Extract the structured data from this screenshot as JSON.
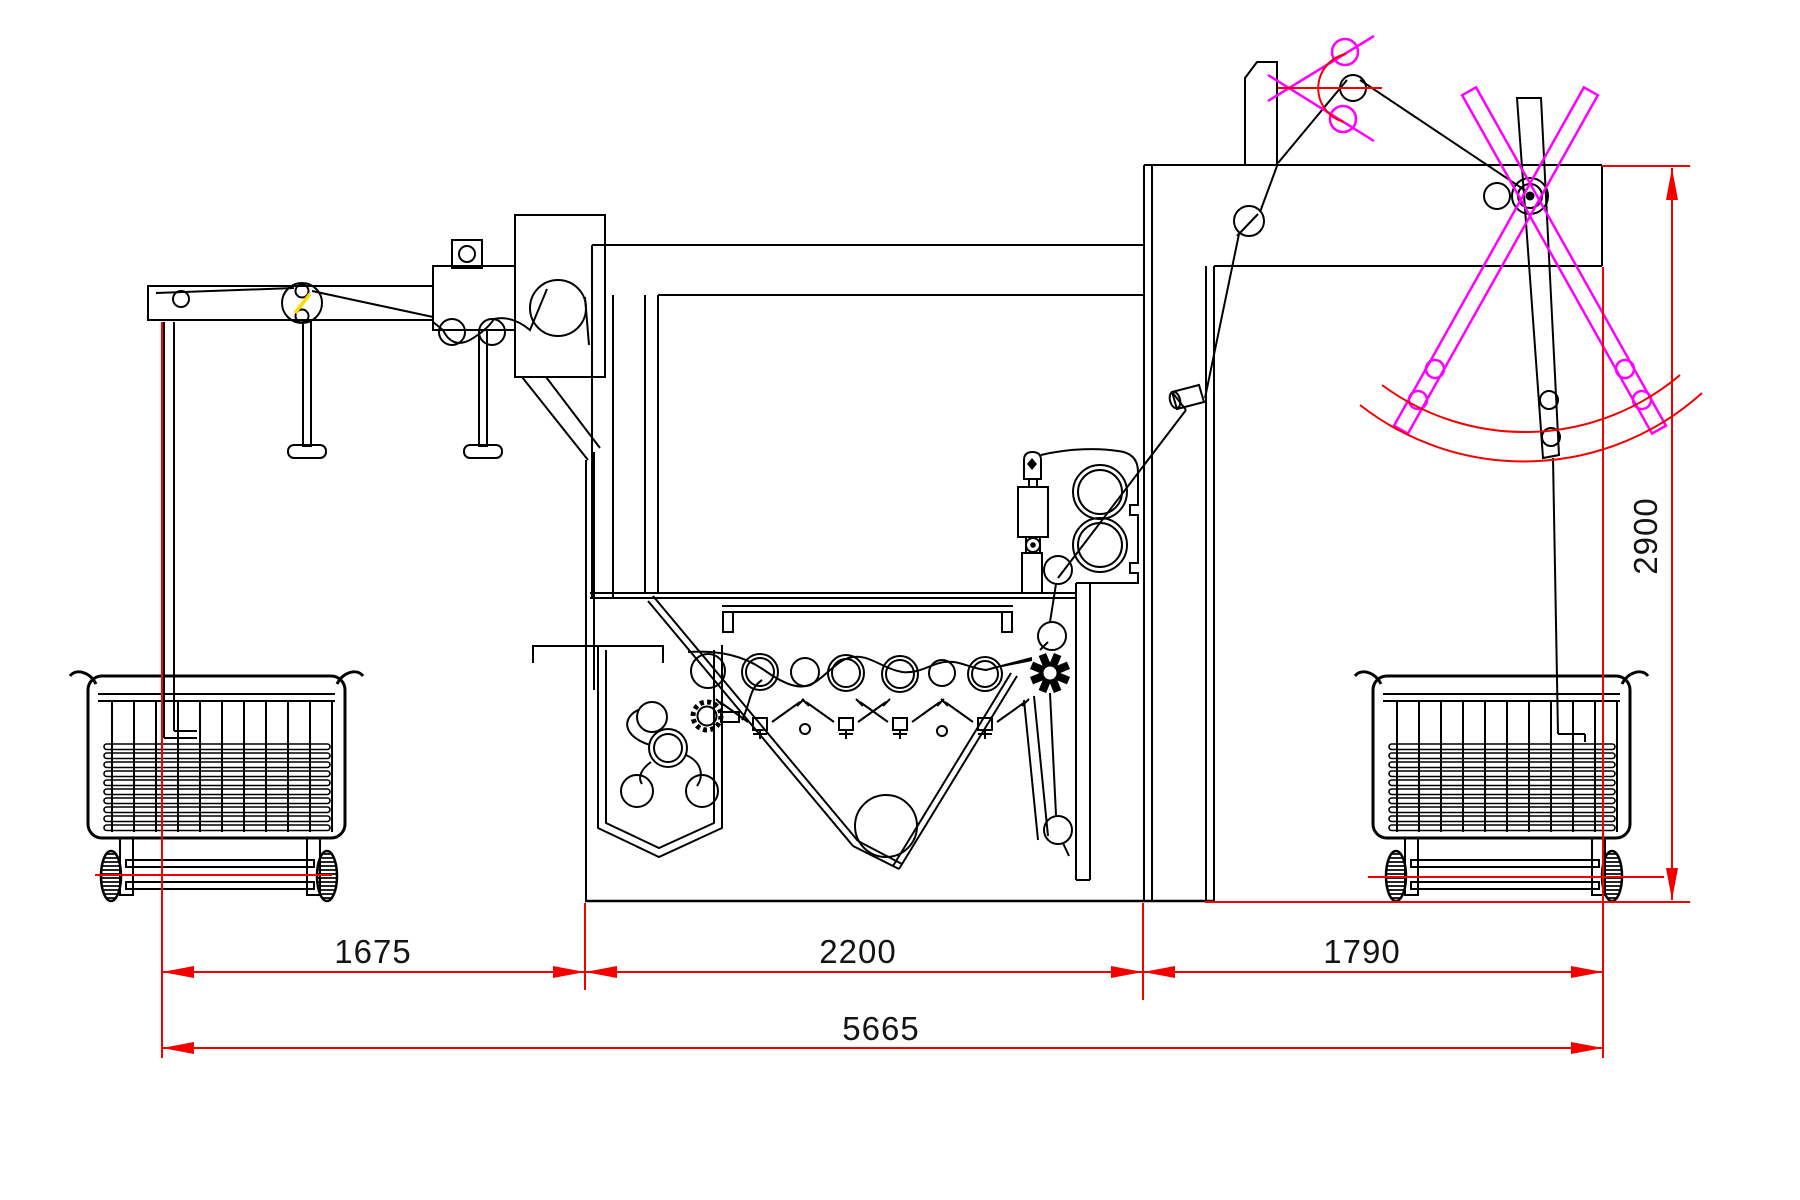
{
  "drawing": {
    "type": "machine-side-elevation",
    "description": "textile draw frame with creel, sliver cans and rotating can changer",
    "dimensions": {
      "left_span": {
        "label": "1675"
      },
      "center_span": {
        "label": "2200"
      },
      "right_span": {
        "label": "1790"
      },
      "total_span": {
        "label": "5665"
      },
      "height": {
        "label": "2900"
      }
    },
    "colors": {
      "line": "#000000",
      "dimension": "#f40000",
      "alternate_position": "#ff00ff",
      "highlight": "#ffd900",
      "text": "#141414",
      "background": "#ffffff"
    }
  }
}
